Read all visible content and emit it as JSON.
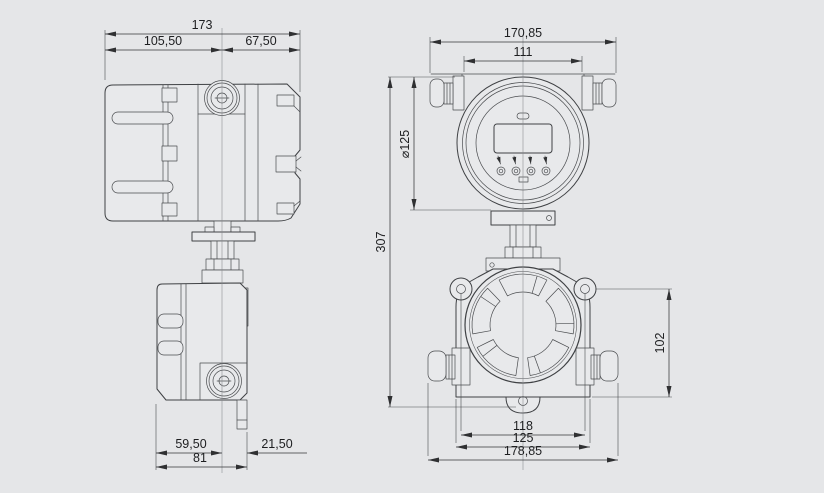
{
  "drawing": {
    "type": "technical-dimension-drawing",
    "views": {
      "left": "flow-transmitter-side-view",
      "right": "flow-transmitter-front-view"
    },
    "colors": {
      "background": "#e5e6e8",
      "outline": "#3f4144",
      "dimension_lines": "#35373a",
      "text": "#1d1e20"
    }
  },
  "dims": {
    "d173": "173",
    "d105_50": "105,50",
    "d67_50": "67,50",
    "d59_50": "59,50",
    "d21_50": "21,50",
    "d81": "81",
    "d170_85": "170,85",
    "d111": "111",
    "d307": "307",
    "d125_dia": "⌀125",
    "d102": "102",
    "d118": "118",
    "d125": "125",
    "d178_85": "178,85"
  }
}
